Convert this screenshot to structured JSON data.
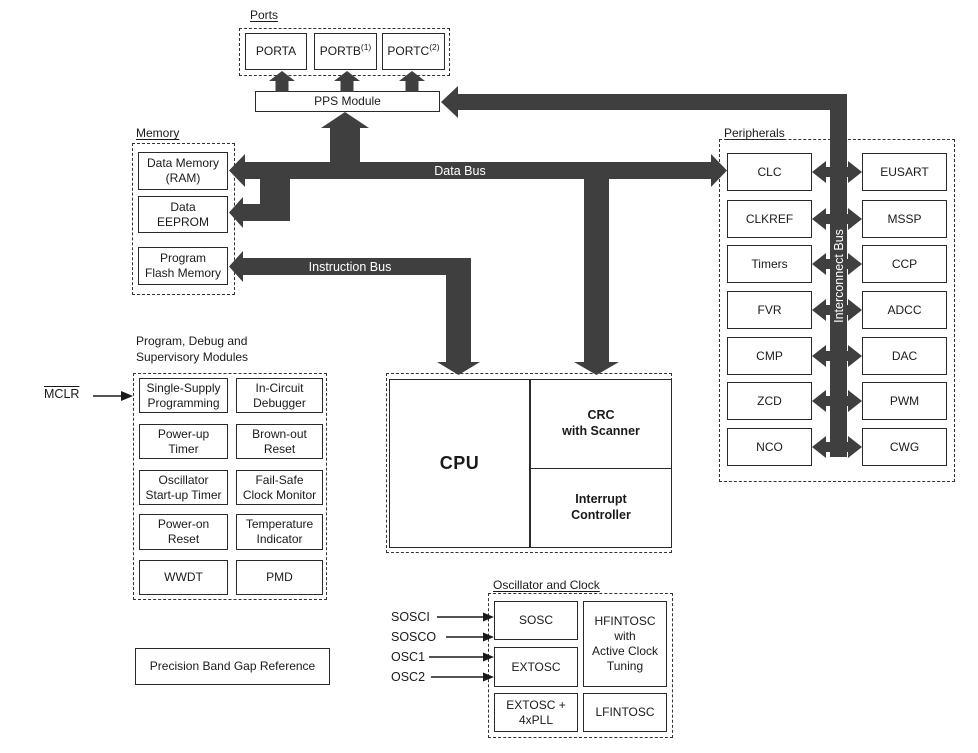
{
  "colors": {
    "bus": "#3f3f3f",
    "box-border": "#2a2a2a",
    "text": "#1a1a1a",
    "bus-label": "#ffffff",
    "background": "#ffffff"
  },
  "ports": {
    "title": "Ports",
    "items": [
      {
        "label": "PORTA",
        "sup": ""
      },
      {
        "label": "PORTB",
        "sup": "(1)"
      },
      {
        "label": "PORTC",
        "sup": "(2)"
      }
    ],
    "pps_label": "PPS Module"
  },
  "memory": {
    "title": "Memory",
    "items": [
      "Data Memory\n(RAM)",
      "Data\nEEPROM",
      "Program\nFlash Memory"
    ]
  },
  "buses": {
    "data_bus": "Data Bus",
    "instruction_bus": "Instruction Bus",
    "interconnect_bus": "Interconnect Bus"
  },
  "cpu": {
    "cpu_label": "CPU",
    "crc_label": "CRC\nwith Scanner",
    "interrupt_label": "Interrupt\nController"
  },
  "peripherals": {
    "title": "Peripherals",
    "left": [
      "CLC",
      "CLKREF",
      "Timers",
      "FVR",
      "CMP",
      "ZCD",
      "NCO"
    ],
    "right": [
      "EUSART",
      "MSSP",
      "CCP",
      "ADCC",
      "DAC",
      "PWM",
      "CWG"
    ]
  },
  "debug": {
    "title": "Program, Debug and\nSupervisory Modules",
    "mclr": "MCLR",
    "left": [
      "Single-Supply\nProgramming",
      "Power-up\nTimer",
      "Oscillator\nStart-up Timer",
      "Power-on\nReset",
      "WWDT"
    ],
    "right": [
      "In-Circuit\nDebugger",
      "Brown-out\nReset",
      "Fail-Safe\nClock Monitor",
      "Temperature\nIndicator",
      "PMD"
    ]
  },
  "oscillator": {
    "title": "Oscillator and Clock",
    "inputs": [
      "SOSCI",
      "SOSCO",
      "OSC1",
      "OSC2"
    ],
    "left": [
      "SOSC",
      "EXTOSC",
      "EXTOSC +\n4xPLL"
    ],
    "right": [
      "HFINTOSC\nwith\nActive Clock\nTuning",
      "LFINTOSC"
    ]
  },
  "bandgap": {
    "label": "Precision Band Gap Reference"
  }
}
